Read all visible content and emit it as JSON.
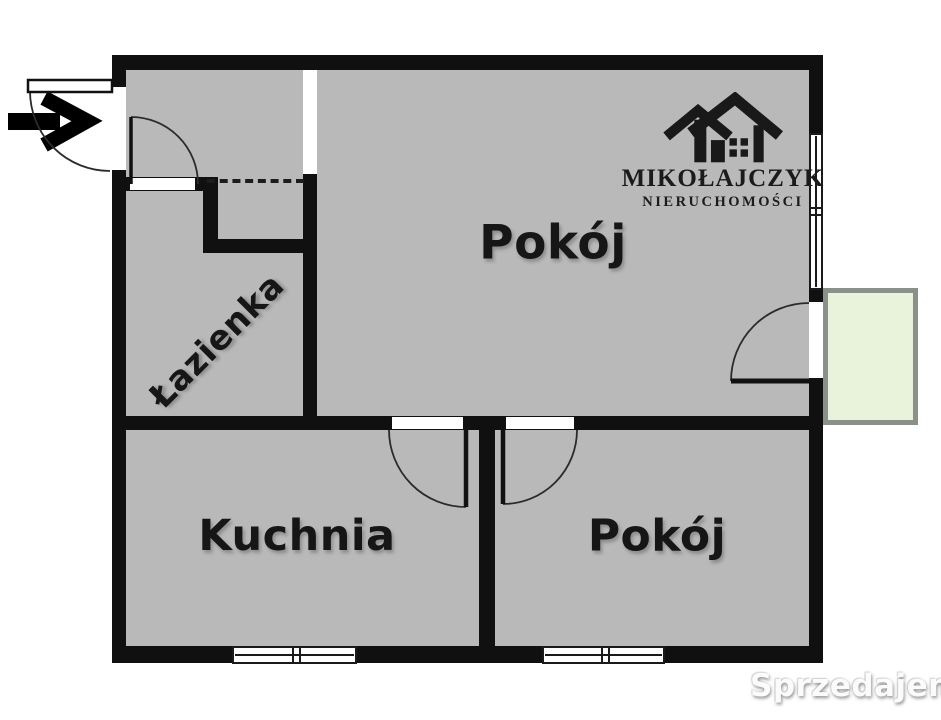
{
  "floorplan": {
    "rooms": {
      "room_top": {
        "label": "Pokój"
      },
      "bathroom": {
        "label": "Łazienka"
      },
      "kitchen": {
        "label": "Kuchnia"
      },
      "room_bottom": {
        "label": "Pokój"
      }
    },
    "features": [
      "balcony",
      "entrance-door",
      "interior-doors",
      "windows",
      "wardrobe-recess"
    ]
  },
  "logo": {
    "title": "MIKOŁAJCZYK",
    "subtitle": "NIERUCHOMOŚCI",
    "icon": "house-logo-icon"
  },
  "watermark": {
    "site": "Sprzedajemy",
    "tld": ".pl"
  },
  "icons": {
    "entrance_arrow": "entrance-arrow-icon",
    "logo_house": "house-logo-icon"
  },
  "colors": {
    "wall": "#101010",
    "floor": "#b9b9b9",
    "balcony_fill": "#e9f3dc",
    "balcony_border": "#8a908a",
    "badge_red": "#d8412f",
    "label_text": "#161616"
  }
}
